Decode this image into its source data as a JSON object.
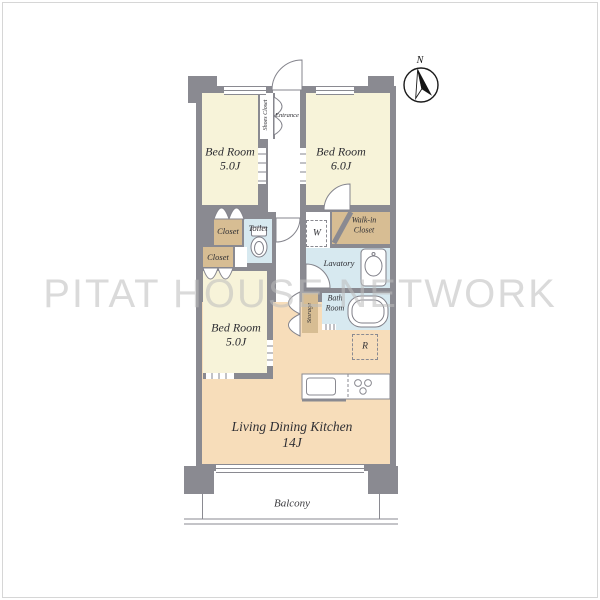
{
  "watermark": {
    "text": "PITAT HOUSE NETWORK"
  },
  "compass": {
    "label": "N"
  },
  "plan": {
    "bedroom_top_left": {
      "name": "Bed Room",
      "size": "5.0J"
    },
    "bedroom_top_right": {
      "name": "Bed Room",
      "size": "6.0J"
    },
    "bedroom_bottom": {
      "name": "Bed Room",
      "size": "5.0J"
    },
    "living": {
      "name": "Living Dining Kitchen",
      "size": "14J"
    },
    "entrance": {
      "label": "Entrance"
    },
    "shoes_closet": {
      "label": "Shoes Closet"
    },
    "closet_upper": {
      "label": "Closet"
    },
    "closet_lower": {
      "label": "Closet"
    },
    "toilet": {
      "label": "Toilet"
    },
    "walk_in_closet": {
      "label": "Walk-in Closet"
    },
    "lavatory": {
      "label": "Lavatory"
    },
    "bath_room": {
      "label": "Bath Room"
    },
    "storage": {
      "label": "Storage"
    },
    "washer": {
      "label": "W"
    },
    "refrigerator": {
      "label": "R"
    },
    "balcony": {
      "label": "Balcony"
    }
  },
  "colors": {
    "wall": "#8a8a91",
    "bedroom_fill": "#f7f3d9",
    "ldk_fill": "#f7ddba",
    "closet_fill": "#d7bd93",
    "wet_area_fill": "#d7e9f0",
    "watermark": "#bdbdbd"
  }
}
